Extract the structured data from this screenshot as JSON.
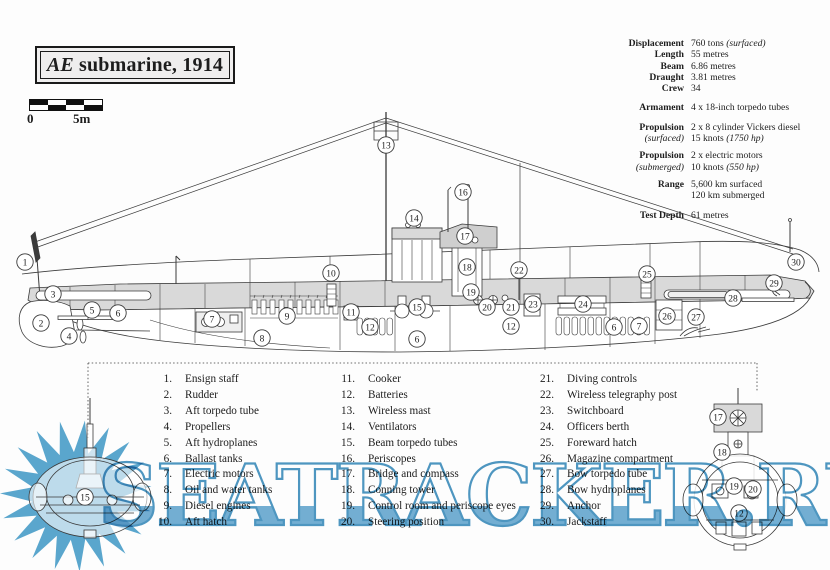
{
  "title": {
    "prefix": "AE",
    "rest": "submarine, 1914"
  },
  "scale_bar": {
    "start": "0",
    "end": "5m"
  },
  "specs": {
    "rows": [
      {
        "label": "Displacement",
        "lines": [
          "760 tons (surfaced)"
        ]
      },
      {
        "label": "Length",
        "lines": [
          "55 metres"
        ]
      },
      {
        "label": "Beam",
        "lines": [
          "6.86 metres"
        ]
      },
      {
        "label": "Draught",
        "lines": [
          "3.81 metres"
        ]
      },
      {
        "label": "Crew",
        "lines": [
          "34"
        ]
      },
      {
        "label": "Armament",
        "gap": "gap1",
        "lines": [
          "4 x 18-inch torpedo tubes"
        ]
      },
      {
        "label": "Propulsion",
        "sub": "(surfaced)",
        "gap": "gap1",
        "lines": [
          "2 x 8 cylinder Vickers diesel",
          "15 knots (1750 hp)"
        ]
      },
      {
        "label": "Propulsion",
        "sub": "(submerged)",
        "gap": "gap2",
        "lines": [
          "2 x electric motors",
          "10 knots (550 hp)"
        ]
      },
      {
        "label": "Range",
        "gap": "gap2",
        "lines": [
          "5,600 km surfaced",
          "120 km submerged"
        ]
      },
      {
        "label": "Test Depth",
        "gap": "gap1",
        "lines": [
          "61 metres"
        ]
      }
    ]
  },
  "parts_list": {
    "columns": [
      [
        {
          "num": "1.",
          "label": "Ensign staff"
        },
        {
          "num": "2.",
          "label": "Rudder"
        },
        {
          "num": "3.",
          "label": "Aft torpedo tube"
        },
        {
          "num": "4.",
          "label": "Propellers"
        },
        {
          "num": "5.",
          "label": "Aft hydroplanes"
        },
        {
          "num": "6.",
          "label": "Ballast tanks"
        },
        {
          "num": "7.",
          "label": "Electric motors"
        },
        {
          "num": "8.",
          "label": "Oil and water tanks"
        },
        {
          "num": "9.",
          "label": "Diesel engines"
        },
        {
          "num": "10.",
          "label": "Aft hatch"
        }
      ],
      [
        {
          "num": "11.",
          "label": "Cooker"
        },
        {
          "num": "12.",
          "label": "Batteries"
        },
        {
          "num": "13.",
          "label": "Wireless mast"
        },
        {
          "num": "14.",
          "label": "Ventilators"
        },
        {
          "num": "15.",
          "label": "Beam torpedo tubes"
        },
        {
          "num": "16.",
          "label": "Periscopes"
        },
        {
          "num": "17.",
          "label": "Bridge and compass"
        },
        {
          "num": "18.",
          "label": "Conning tower"
        },
        {
          "num": "19.",
          "label": "Control room and periscope eyes"
        },
        {
          "num": "20.",
          "label": "Steering position"
        }
      ],
      [
        {
          "num": "21.",
          "label": "Diving controls"
        },
        {
          "num": "22.",
          "label": "Wireless telegraphy post"
        },
        {
          "num": "23.",
          "label": "Switchboard"
        },
        {
          "num": "24.",
          "label": "Officers berth"
        },
        {
          "num": "25.",
          "label": "Foreward hatch"
        },
        {
          "num": "26.",
          "label": "Magazine compartment"
        },
        {
          "num": "27.",
          "label": "Bow torpedo tube"
        },
        {
          "num": "28.",
          "label": "Bow hydroplanes"
        },
        {
          "num": "29.",
          "label": "Anchor"
        },
        {
          "num": "30.",
          "label": "Jackstaff"
        }
      ]
    ]
  },
  "callouts": [
    {
      "n": "1",
      "x": 25,
      "y": 262
    },
    {
      "n": "2",
      "x": 41,
      "y": 323
    },
    {
      "n": "3",
      "x": 53,
      "y": 294
    },
    {
      "n": "4",
      "x": 69,
      "y": 336
    },
    {
      "n": "5",
      "x": 92,
      "y": 310
    },
    {
      "n": "6",
      "x": 118,
      "y": 313
    },
    {
      "n": "7",
      "x": 212,
      "y": 319
    },
    {
      "n": "8",
      "x": 262,
      "y": 338
    },
    {
      "n": "9",
      "x": 287,
      "y": 316
    },
    {
      "n": "10",
      "x": 331,
      "y": 273
    },
    {
      "n": "11",
      "x": 351,
      "y": 312
    },
    {
      "n": "12",
      "x": 370,
      "y": 327
    },
    {
      "n": "13",
      "x": 386,
      "y": 145
    },
    {
      "n": "14",
      "x": 414,
      "y": 218
    },
    {
      "n": "15",
      "x": 417,
      "y": 307
    },
    {
      "n": "16",
      "x": 463,
      "y": 192
    },
    {
      "n": "17",
      "x": 465,
      "y": 236
    },
    {
      "n": "18",
      "x": 467,
      "y": 267
    },
    {
      "n": "19",
      "x": 471,
      "y": 292
    },
    {
      "n": "20",
      "x": 487,
      "y": 307
    },
    {
      "n": "21",
      "x": 511,
      "y": 307
    },
    {
      "n": "12",
      "x": 511,
      "y": 326
    },
    {
      "n": "22",
      "x": 519,
      "y": 270
    },
    {
      "n": "23",
      "x": 533,
      "y": 304
    },
    {
      "n": "24",
      "x": 583,
      "y": 304
    },
    {
      "n": "6",
      "x": 417,
      "y": 339
    },
    {
      "n": "25",
      "x": 647,
      "y": 274
    },
    {
      "n": "6",
      "x": 614,
      "y": 327
    },
    {
      "n": "7",
      "x": 639,
      "y": 326
    },
    {
      "n": "26",
      "x": 667,
      "y": 316
    },
    {
      "n": "27",
      "x": 696,
      "y": 317
    },
    {
      "n": "28",
      "x": 733,
      "y": 298
    },
    {
      "n": "29",
      "x": 774,
      "y": 283
    },
    {
      "n": "30",
      "x": 796,
      "y": 262
    },
    {
      "n": "15",
      "x": 85,
      "y": 497
    },
    {
      "n": "17",
      "x": 718,
      "y": 417
    },
    {
      "n": "18",
      "x": 722,
      "y": 452
    },
    {
      "n": "19",
      "x": 734,
      "y": 486
    },
    {
      "n": "20",
      "x": 753,
      "y": 489
    },
    {
      "n": "12",
      "x": 739,
      "y": 513
    }
  ],
  "watermark": {
    "text": "SEATRACKER.RU",
    "fill_color": "#74b0d4",
    "outline_color": "#4e97c2",
    "star_color": "#5aa6cd"
  },
  "colors": {
    "casing": "#d9d9d9",
    "line": "#3b3b3b",
    "paper": "#fdfdfd"
  }
}
